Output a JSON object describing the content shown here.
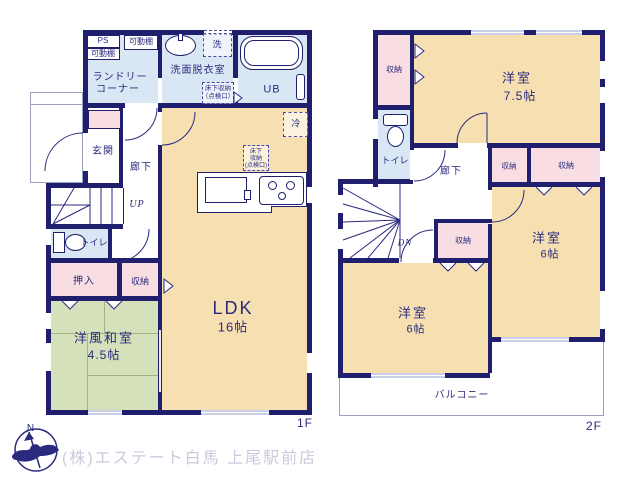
{
  "colors": {
    "wall": "#1f1f6e",
    "text": "#2a2a7e",
    "room_cream": "#f6e0b2",
    "room_pink": "#f8dde2",
    "room_green": "#d5e1ba",
    "room_blue": "#d9e6f3",
    "footer_text": "#c9cade"
  },
  "footer": {
    "company": "(株)エステート白馬 上尾駅前店",
    "north": "N"
  },
  "f1": {
    "floor_label": "1F",
    "ps": "PS",
    "shelf_a": "可動棚",
    "shelf_b": "可動棚",
    "laundry_1": "ランドリー",
    "laundry_2": "コーナー",
    "washroom": "洗面脱衣室",
    "washer": "洗",
    "underfloor_wash_1": "床下収納",
    "underfloor_wash_2": "（点検口）",
    "bath": "UB",
    "fridge": "冷",
    "underfloor_ldk_1": "床下",
    "underfloor_ldk_2": "収納",
    "underfloor_ldk_3": "(点検口)",
    "entrance": "玄関",
    "hall": "廊下",
    "stairs": "UP",
    "toilet": "トイレ",
    "closet": "押入",
    "storage": "収納",
    "tatami_name": "洋風和室",
    "tatami_size": "4.5帖",
    "ldk_name": "LDK",
    "ldk_size": "16帖"
  },
  "f2": {
    "floor_label": "2F",
    "storage_nw": "収納",
    "storage_a": "収納",
    "storage_b": "収納",
    "storage_c": "収納",
    "bed_a_name": "洋室",
    "bed_a_size": "7.5帖",
    "toilet": "トイレ",
    "hall": "廊下",
    "stairs": "DN",
    "bed_b_name": "洋室",
    "bed_b_size": "6帖",
    "bed_c_name": "洋室",
    "bed_c_size": "6帖",
    "balcony": "バルコニー"
  }
}
